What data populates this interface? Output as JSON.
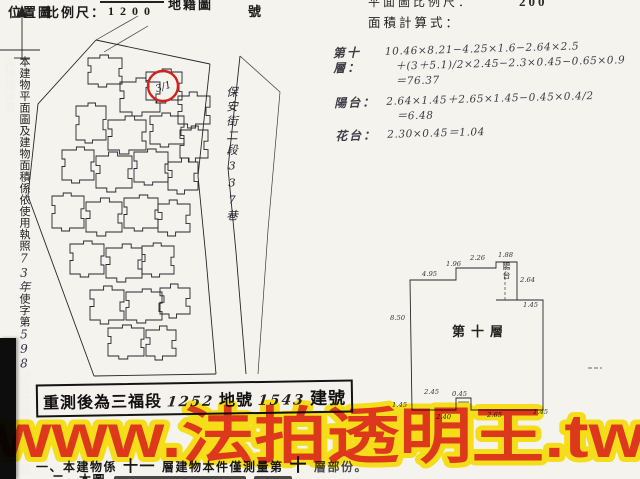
{
  "header": {
    "location_map_label": "位置圖",
    "scale_label": "比例尺：",
    "scale_value": "1200",
    "cadastral_label": "地籍圖",
    "sheet_number_label": "號",
    "plan_scale_label": "平面圖比例尺：",
    "plan_scale_value": "200",
    "area_formula_label": "面積計算式："
  },
  "left_note": {
    "part1": "本建物平面圖及建物面積係依使用執照",
    "hand1": "73年",
    "part2": "使字第",
    "hand2": "598",
    "part3": "號設計圖或竣工平面圖轉繪計算"
  },
  "site_map": {
    "street_label": "保安街二段337巷",
    "parcel_label": "3/1"
  },
  "calc": {
    "blocks": [
      {
        "label": "第十層：",
        "lines": [
          "10.46×8.21−4.25×1.6−2.64×2.5",
          "＋(3＋5.1)/2×2.45−2.3×0.45−0.65×0.9",
          "＝76.37"
        ]
      },
      {
        "label": "陽台：",
        "lines": [
          "2.64×1.45＋2.65×1.45−0.45×0.4/2",
          "＝6.48"
        ]
      },
      {
        "label": "花台：",
        "lines": [
          "2.30×0.45＝1.04"
        ]
      }
    ]
  },
  "floor_plan": {
    "room_label": "第十層",
    "balcony_label": "陽台",
    "dims": [
      {
        "t": "8.50"
      },
      {
        "t": "4.95"
      },
      {
        "t": "1.96"
      },
      {
        "t": "2.26"
      },
      {
        "t": "1.88"
      },
      {
        "t": "2.64"
      },
      {
        "t": "1.45"
      },
      {
        "t": "2.45"
      },
      {
        "t": "0.45"
      },
      {
        "t": "1.45"
      },
      {
        "t": "2.40"
      },
      {
        "t": "2.65"
      },
      {
        "t": "1.45"
      }
    ]
  },
  "stamp": {
    "prefix": "重測後為三福段",
    "land_number": "1252",
    "land_label": "地號",
    "building_number": "1543",
    "building_label": "建號"
  },
  "notes": {
    "line1_prefix": "一、本建物係",
    "line1_total_floors": "十一",
    "line1_mid": "層建物本件僅測量第",
    "line1_floor": "十",
    "line1_suffix": "層部份。",
    "line2_prefix": "二、本圖"
  },
  "watermark": {
    "text": "www.法拍透明王.tw",
    "fill": "#e63a1e",
    "outline": "#ffe81a"
  },
  "colors": {
    "paper": "#f5f3ee",
    "ink": "#1c1c1c",
    "handwriting": "#3c3c46",
    "stamp_red": "#cf241c"
  }
}
